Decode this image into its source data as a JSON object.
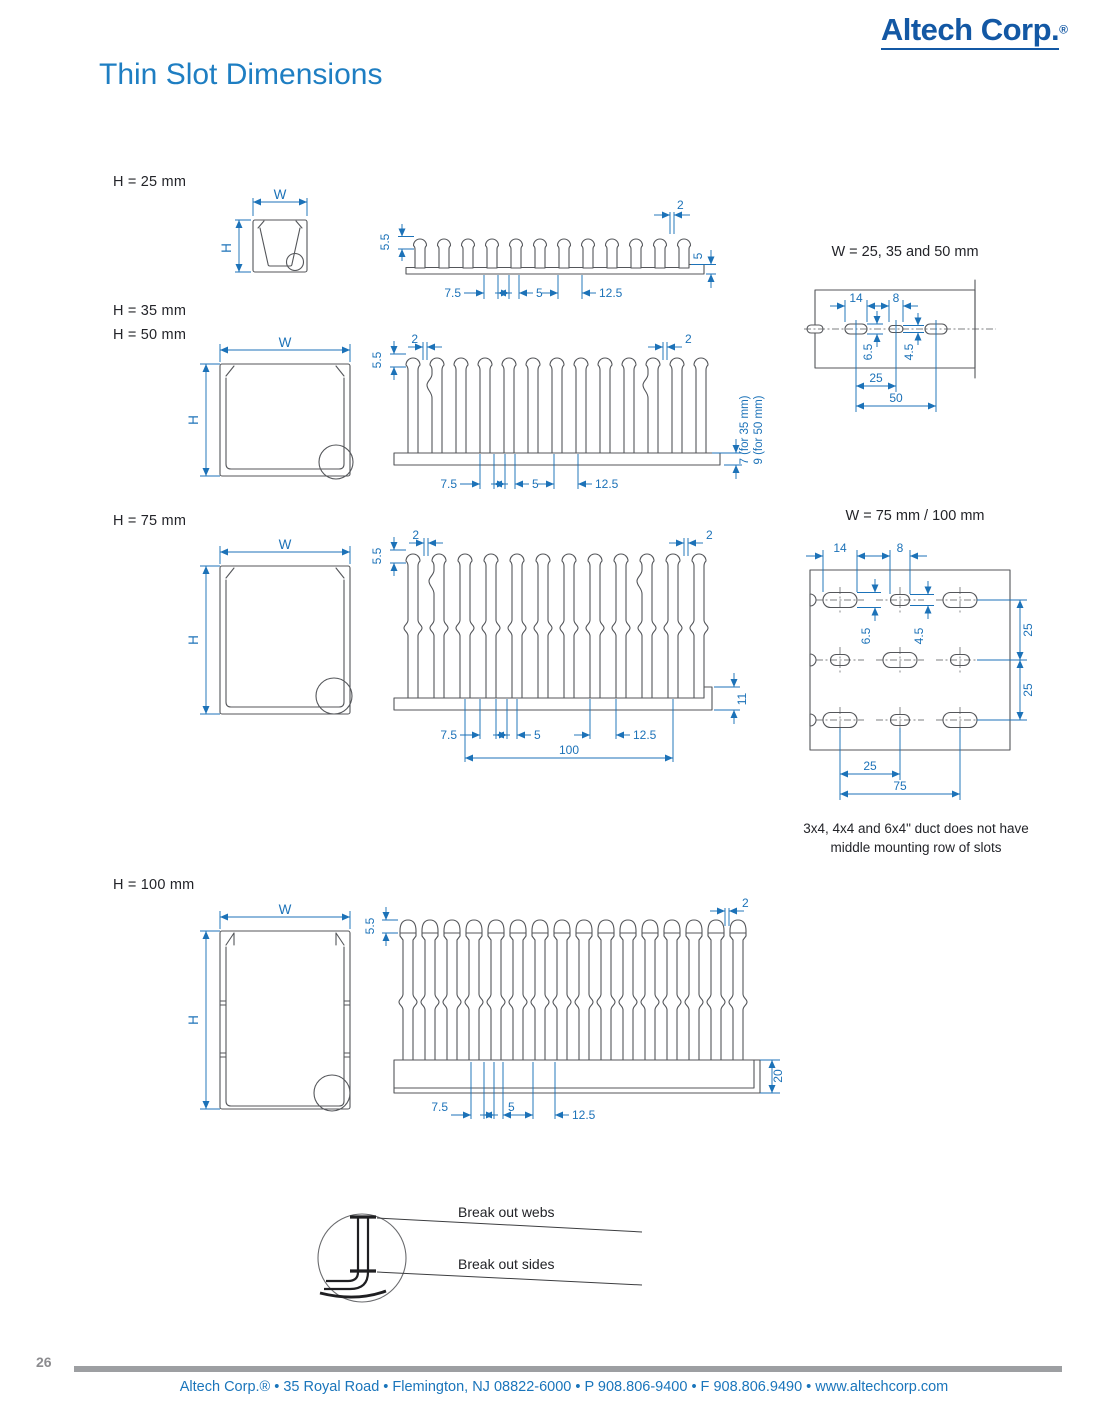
{
  "page": {
    "logo_text": "Altech Corp.",
    "logo_reg": "®",
    "title": "Thin Slot Dimensions",
    "page_number": "26",
    "footer_text": "Altech Corp.® • 35 Royal Road • Flemington, NJ 08822-6000 • P 908.806-9400 • F 908.806.9490 • www.altechcorp.com"
  },
  "sections": {
    "h25": {
      "heading": "H = 25 mm",
      "w_label": "W",
      "h_label": "H",
      "dims": {
        "head_height": "5.5",
        "slot_top_width": "2",
        "wall": "5",
        "web": "7.5",
        "slot": "5",
        "pitch": "12.5"
      }
    },
    "h35_50": {
      "heading_35": "H = 35 mm",
      "heading_50": "H = 50 mm",
      "w_label": "W",
      "h_label": "H",
      "dims": {
        "head_height": "5.5",
        "slot_top_left": "2",
        "slot_top_right": "2",
        "web": "7.5",
        "slot": "5",
        "pitch": "12.5",
        "base_35": "7 (for 35 mm)",
        "base_50": "9 (for 50 mm)"
      }
    },
    "h75": {
      "heading": "H = 75 mm",
      "w_label": "W",
      "h_label": "H",
      "dims": {
        "head_height": "5.5",
        "slot_top_left": "2",
        "slot_top_right": "2",
        "foot": "11",
        "web": "7.5",
        "slot": "5",
        "pitch": "12.5",
        "span": "100"
      }
    },
    "h100": {
      "heading": "H = 100 mm",
      "w_label": "W",
      "h_label": "H",
      "dims": {
        "head_height": "5.5",
        "slot_top_width": "2",
        "base": "20",
        "web": "7.5",
        "slot": "5",
        "pitch": "12.5"
      }
    }
  },
  "patterns": {
    "small": {
      "title": "W = 25, 35 and 50 mm",
      "dims": {
        "slot_large": "14",
        "slot_small": "8",
        "slot_large_h": "6.5",
        "slot_small_h": "4.5",
        "spacing": "25",
        "span": "50"
      }
    },
    "large": {
      "title": "W = 75 mm / 100 mm",
      "dims": {
        "slot_large": "14",
        "slot_small": "8",
        "slot_large_h": "6.5",
        "slot_small_h": "4.5",
        "row_1": "25",
        "row_2": "25",
        "col": "25",
        "span": "75"
      },
      "note_line1": "3x4, 4x4 and 6x4\" duct does not have",
      "note_line2": "middle mounting row of slots"
    }
  },
  "breakout": {
    "webs": "Break out webs",
    "sides": "Break out sides"
  },
  "colors": {
    "dimension_blue": "#1c72b8",
    "title_blue": "#1e7ec2",
    "logo_blue": "#1358a4",
    "line_gray": "#54565a",
    "footer_blue": "#1a75bb"
  }
}
